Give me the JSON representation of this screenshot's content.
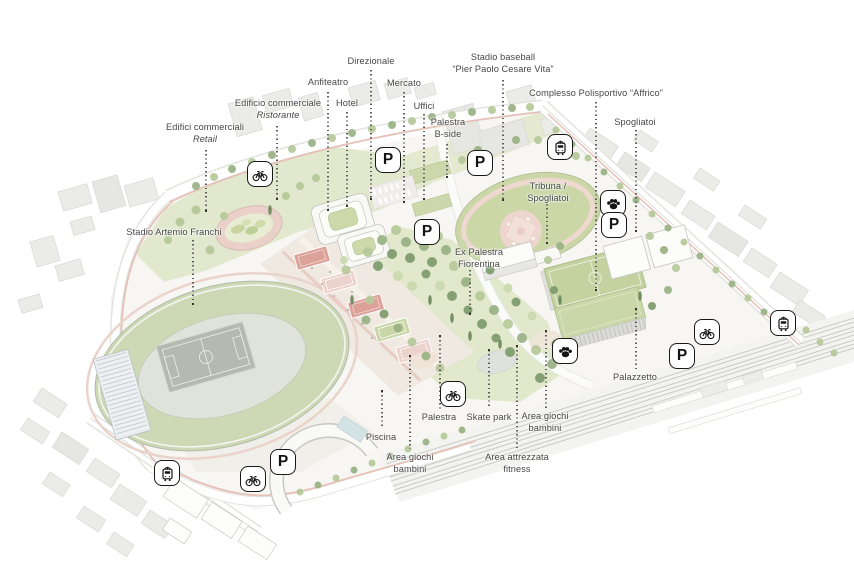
{
  "canvas": {
    "width": 854,
    "height": 570,
    "background": "#ffffff"
  },
  "palette": {
    "label_text": "#474747",
    "leader_line": "#5e5e5e",
    "badge_outline": "#181818",
    "field_green": "#cbd7a6",
    "stadium_roof_green": "#cdd8b5",
    "lawn_green": "#e2e8cd",
    "track_pink": "#e9d2c9",
    "court_red": "#dca299",
    "promenade_beige": "#efe9e1",
    "building_white": "#fbfbf8",
    "context_gray": "#ebebe8",
    "railway_gray": "#cacac7"
  },
  "map": {
    "badge_glyphs": {
      "parking": "P"
    },
    "labels": [
      {
        "id": "edifici-commerciali-retail",
        "x": 205,
        "y": 121,
        "lines": [
          {
            "text": "Edifici commerciali",
            "italic": false
          },
          {
            "text": "Retail",
            "italic": true
          }
        ]
      },
      {
        "id": "edificio-commerciale-ristorante",
        "x": 278,
        "y": 97,
        "lines": [
          {
            "text": "Edificio commerciale",
            "italic": false
          },
          {
            "text": "Ristorante",
            "italic": true
          }
        ]
      },
      {
        "id": "anfiteatro",
        "x": 328,
        "y": 76,
        "lines": [
          {
            "text": "Anfiteatro",
            "italic": false
          }
        ]
      },
      {
        "id": "hotel",
        "x": 347,
        "y": 97,
        "lines": [
          {
            "text": "Hotel",
            "italic": false
          }
        ]
      },
      {
        "id": "direzionale",
        "x": 371,
        "y": 55,
        "lines": [
          {
            "text": "Direzionale",
            "italic": false
          }
        ]
      },
      {
        "id": "mercato",
        "x": 404,
        "y": 77,
        "lines": [
          {
            "text": "Mercato",
            "italic": false
          }
        ]
      },
      {
        "id": "uffici",
        "x": 424,
        "y": 100,
        "lines": [
          {
            "text": "Uffici",
            "italic": false
          }
        ]
      },
      {
        "id": "palestra-b-side",
        "x": 448,
        "y": 116,
        "lines": [
          {
            "text": "Palestra",
            "italic": false
          },
          {
            "text": "B-side",
            "italic": false
          }
        ]
      },
      {
        "id": "stadio-baseball",
        "x": 503,
        "y": 51,
        "lines": [
          {
            "text": "Stadio baseball",
            "italic": false
          },
          {
            "text": "“Pier Paolo Cesare Vita”",
            "italic": false
          }
        ]
      },
      {
        "id": "complesso-polisportivo-affrico",
        "x": 596,
        "y": 87,
        "lines": [
          {
            "text": "Complesso Polisportivo “Affrico”",
            "italic": false
          }
        ]
      },
      {
        "id": "spogliatoi-nord",
        "x": 635,
        "y": 116,
        "lines": [
          {
            "text": "Spogliatoi",
            "italic": false
          }
        ]
      },
      {
        "id": "tribuna-spogliatoi",
        "x": 548,
        "y": 180,
        "lines": [
          {
            "text": "Tribuna /",
            "italic": false
          },
          {
            "text": "Spogliatoi",
            "italic": false
          }
        ]
      },
      {
        "id": "stadio-artemio-franchi",
        "x": 174,
        "y": 226,
        "lines": [
          {
            "text": "Stadio Artemio Franchi",
            "italic": false
          }
        ]
      },
      {
        "id": "ex-palestra-fiorentina",
        "x": 479,
        "y": 246,
        "lines": [
          {
            "text": "Ex Palestra",
            "italic": false
          },
          {
            "text": "Fiorentina",
            "italic": false
          }
        ]
      },
      {
        "id": "palazzetto",
        "x": 635,
        "y": 371,
        "lines": [
          {
            "text": "Palazzetto",
            "italic": false
          }
        ]
      },
      {
        "id": "palestra",
        "x": 439,
        "y": 411,
        "lines": [
          {
            "text": "Palestra",
            "italic": false
          }
        ]
      },
      {
        "id": "skate-park",
        "x": 489,
        "y": 411,
        "lines": [
          {
            "text": "Skate park",
            "italic": false
          }
        ]
      },
      {
        "id": "area-giochi-bambini-est",
        "x": 545,
        "y": 410,
        "lines": [
          {
            "text": "Area giochi",
            "italic": false
          },
          {
            "text": "bambini",
            "italic": false
          }
        ]
      },
      {
        "id": "piscina",
        "x": 381,
        "y": 431,
        "lines": [
          {
            "text": "Piscina",
            "italic": false
          }
        ]
      },
      {
        "id": "area-giochi-bambini-ovest",
        "x": 410,
        "y": 451,
        "lines": [
          {
            "text": "Area giochi",
            "italic": false
          },
          {
            "text": "bambini",
            "italic": false
          }
        ]
      },
      {
        "id": "area-attrezzata-fitness",
        "x": 517,
        "y": 451,
        "lines": [
          {
            "text": "Area attrezzata",
            "italic": false
          },
          {
            "text": "fitness",
            "italic": false
          }
        ]
      }
    ],
    "leaders": [
      {
        "x": 206,
        "y1": 150,
        "y2": 211,
        "dot": "bottom"
      },
      {
        "x": 277,
        "y1": 126,
        "y2": 199,
        "dot": "bottom"
      },
      {
        "x": 328,
        "y1": 92,
        "y2": 210,
        "dot": "bottom"
      },
      {
        "x": 347,
        "y1": 112,
        "y2": 206,
        "dot": "bottom"
      },
      {
        "x": 371,
        "y1": 70,
        "y2": 199,
        "dot": "bottom"
      },
      {
        "x": 404,
        "y1": 92,
        "y2": 202,
        "dot": "bottom"
      },
      {
        "x": 424,
        "y1": 114,
        "y2": 199,
        "dot": "bottom"
      },
      {
        "x": 447,
        "y1": 144,
        "y2": 177,
        "dot": "bottom"
      },
      {
        "x": 503,
        "y1": 80,
        "y2": 200,
        "dot": "bottom"
      },
      {
        "x": 596,
        "y1": 102,
        "y2": 290,
        "dot": "bottom"
      },
      {
        "x": 636,
        "y1": 130,
        "y2": 231,
        "dot": "bottom"
      },
      {
        "x": 547,
        "y1": 204,
        "y2": 243,
        "dot": "bottom"
      },
      {
        "x": 193,
        "y1": 240,
        "y2": 304,
        "dot": "bottom"
      },
      {
        "x": 470,
        "y1": 270,
        "y2": 314,
        "dot": "bottom"
      },
      {
        "x": 636,
        "y1": 309,
        "y2": 369,
        "dot": "top"
      },
      {
        "x": 440,
        "y1": 336,
        "y2": 409,
        "dot": "top"
      },
      {
        "x": 489,
        "y1": 350,
        "y2": 409,
        "dot": "top"
      },
      {
        "x": 546,
        "y1": 331,
        "y2": 408,
        "dot": "top"
      },
      {
        "x": 382,
        "y1": 391,
        "y2": 429,
        "dot": "top"
      },
      {
        "x": 410,
        "y1": 356,
        "y2": 449,
        "dot": "top"
      },
      {
        "x": 517,
        "y1": 346,
        "y2": 449,
        "dot": "top"
      }
    ],
    "badges": [
      {
        "type": "bicycle",
        "x": 260,
        "y": 174
      },
      {
        "type": "parking",
        "x": 388,
        "y": 160
      },
      {
        "type": "parking",
        "x": 480,
        "y": 163
      },
      {
        "type": "tram",
        "x": 560,
        "y": 147
      },
      {
        "type": "paw",
        "x": 613,
        "y": 203
      },
      {
        "type": "parking",
        "x": 614,
        "y": 225
      },
      {
        "type": "parking",
        "x": 427,
        "y": 232
      },
      {
        "type": "paw",
        "x": 565,
        "y": 351
      },
      {
        "type": "bicycle",
        "x": 707,
        "y": 332
      },
      {
        "type": "parking",
        "x": 682,
        "y": 356
      },
      {
        "type": "tram",
        "x": 783,
        "y": 323
      },
      {
        "type": "bicycle",
        "x": 453,
        "y": 394
      },
      {
        "type": "tram",
        "x": 167,
        "y": 473
      },
      {
        "type": "parking",
        "x": 283,
        "y": 462
      },
      {
        "type": "bicycle",
        "x": 253,
        "y": 479
      }
    ]
  }
}
